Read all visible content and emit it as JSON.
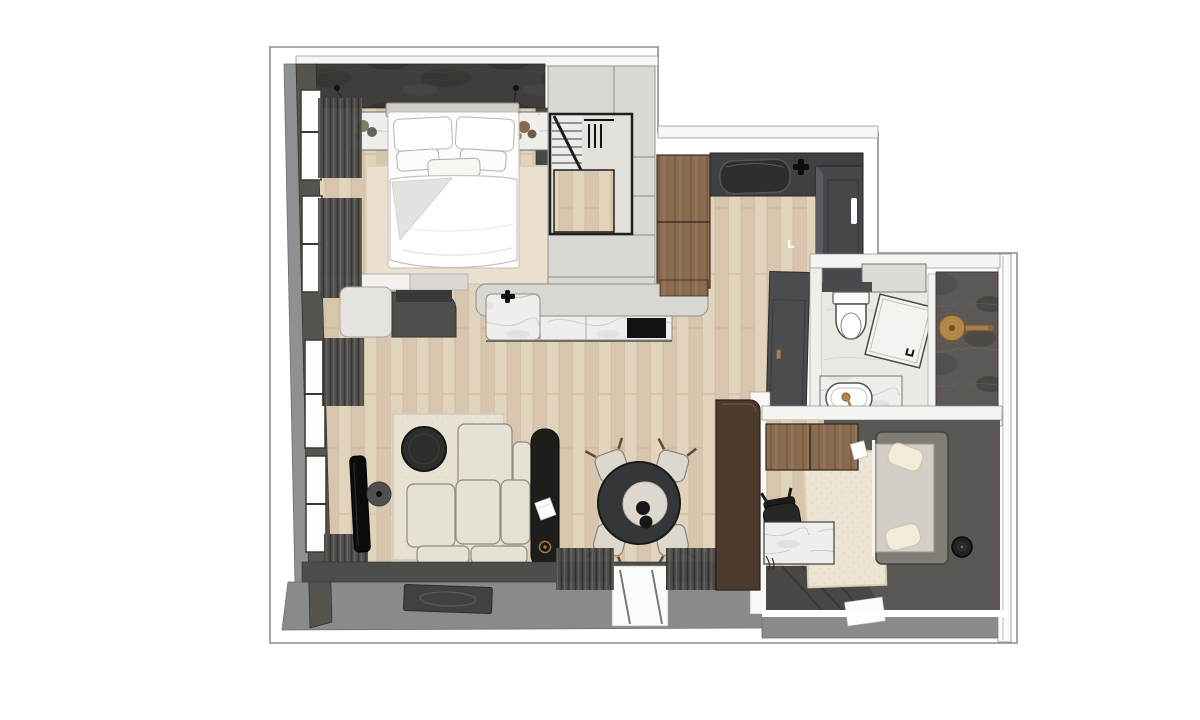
{
  "scene": {
    "type": "apartment-floor-plan",
    "label": "Rendered top-down apartment floor plan",
    "view": "3d-top-view-render",
    "background": "#ffffff"
  },
  "palette": {
    "outline": "#8e8e8e",
    "wood_floor": "#ddccb6",
    "wood_cabinet": "#8a6c51",
    "wall_dark": "#56544f",
    "wall_white": "#f6f6f4",
    "counter_dark": "#3e4043",
    "surface_light_gray": "#d9d8d2",
    "marble_white": "#efeeec",
    "marble_dark": "#5b5855",
    "rug_cream": "#ece5d3",
    "sofa_cream": "#e6e1d5",
    "furniture_black": "#1d1d1c",
    "brass_gold": "#b5854a",
    "terrace_gray": "#898a8c",
    "brown_wardrobe": "#4c3a2d"
  },
  "rooms": [
    {
      "name": "bedroom",
      "furniture": [
        "double-bed",
        "pillows",
        "duvet",
        "nightstand-left",
        "nightstand-right",
        "pendant-lamps",
        "area-rug",
        "headboard-wall",
        "windows",
        "curtains"
      ]
    },
    {
      "name": "staircase",
      "furniture": [
        "stair-treads",
        "railing",
        "landing"
      ]
    },
    {
      "name": "kitchen",
      "furniture": [
        "tall-wood-cabinet",
        "dark-counter",
        "sink",
        "faucet",
        "fridge-unit",
        "island-counter",
        "marble-island-front",
        "cooktop-black",
        "island-faucet"
      ]
    },
    {
      "name": "living-room",
      "furniture": [
        "modular-sofa",
        "black-chaise",
        "coffee-table-round",
        "tv-panel",
        "floor-lamp",
        "area-rug",
        "vanity-desk",
        "doormat",
        "curtains",
        "balcony-door"
      ]
    },
    {
      "name": "dining-area",
      "furniture": [
        "round-table",
        "lazy-susan",
        "two-vases",
        "chair-top-left",
        "chair-top-right",
        "chair-bottom-left",
        "chair-bottom-right"
      ]
    },
    {
      "name": "hallway",
      "furniture": [
        "tall-dark-cabinet"
      ]
    },
    {
      "name": "bathroom",
      "furniture": [
        "toilet",
        "shower-glass-door",
        "dark-marble-shower",
        "brass-rain-shower",
        "vanity-basin",
        "brass-faucet",
        "wall-shelf"
      ]
    },
    {
      "name": "study",
      "furniture": [
        "wood-desk-cabinets",
        "marble-desk",
        "office-chair",
        "area-rug",
        "lounge-sofa",
        "cushions",
        "robot-vacuum",
        "entry-mat"
      ]
    }
  ]
}
